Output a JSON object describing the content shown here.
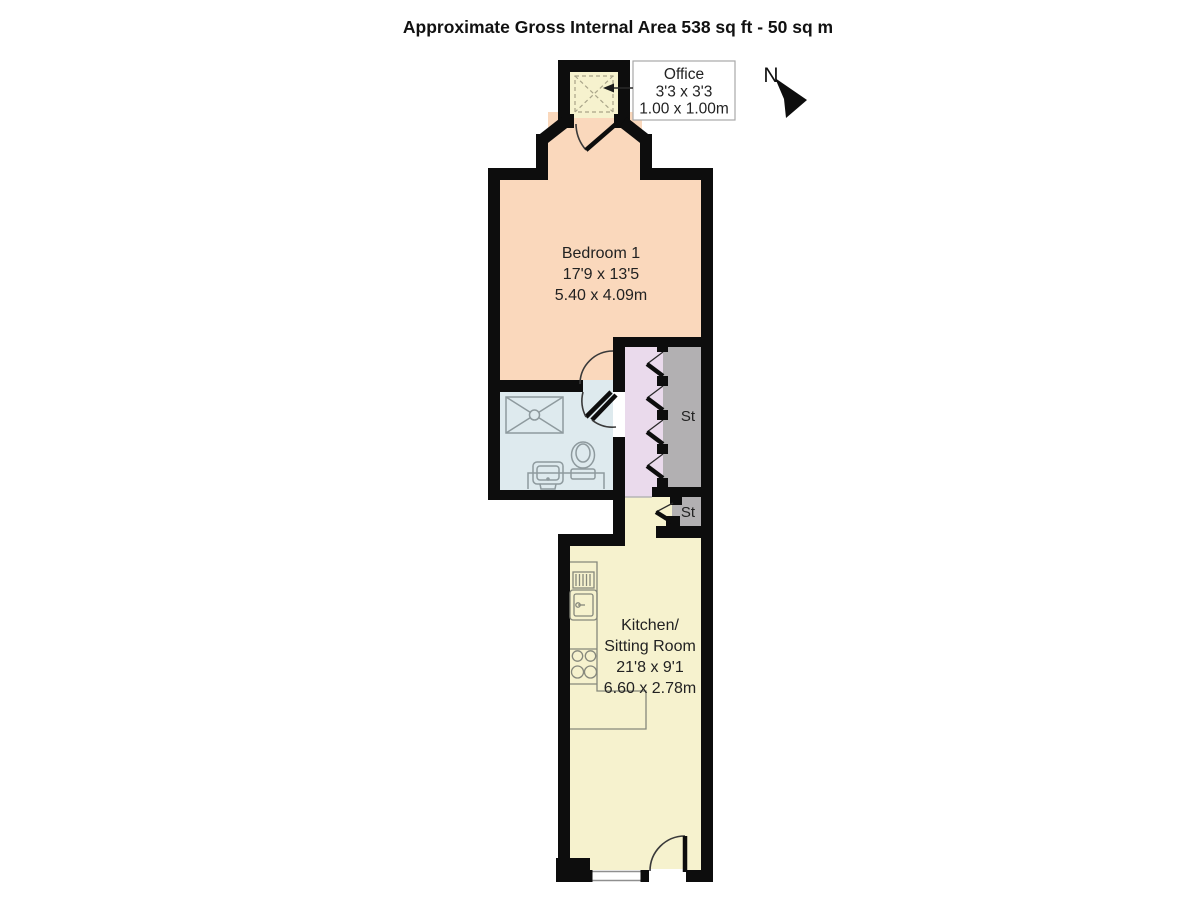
{
  "title": "Approximate Gross Internal Area 538 sq ft - 50 sq m",
  "compass": {
    "label": "N"
  },
  "rooms": {
    "office": {
      "name": "Office",
      "size_imperial": "3'3 x 3'3",
      "size_metric": "1.00 x 1.00m"
    },
    "bedroom": {
      "name": "Bedroom 1",
      "size_imperial": "17'9 x 13'5",
      "size_metric": "5.40 x 4.09m"
    },
    "kitchen_sitting": {
      "name_line1": "Kitchen/",
      "name_line2": "Sitting Room",
      "size_imperial": "21'8 x 9'1",
      "size_metric": "6.60 x 2.78m"
    },
    "storage_large": {
      "label": "St"
    },
    "storage_small": {
      "label": "St"
    }
  },
  "colors": {
    "bedroom": "#FAD8BC",
    "kitchen": "#F6F2CE",
    "office": "#F6F2CE",
    "bathroom": "#DEEAEE",
    "hallway": "#EADAEC",
    "storage": "#B2B0B2",
    "wall": "#0D0D0D"
  }
}
